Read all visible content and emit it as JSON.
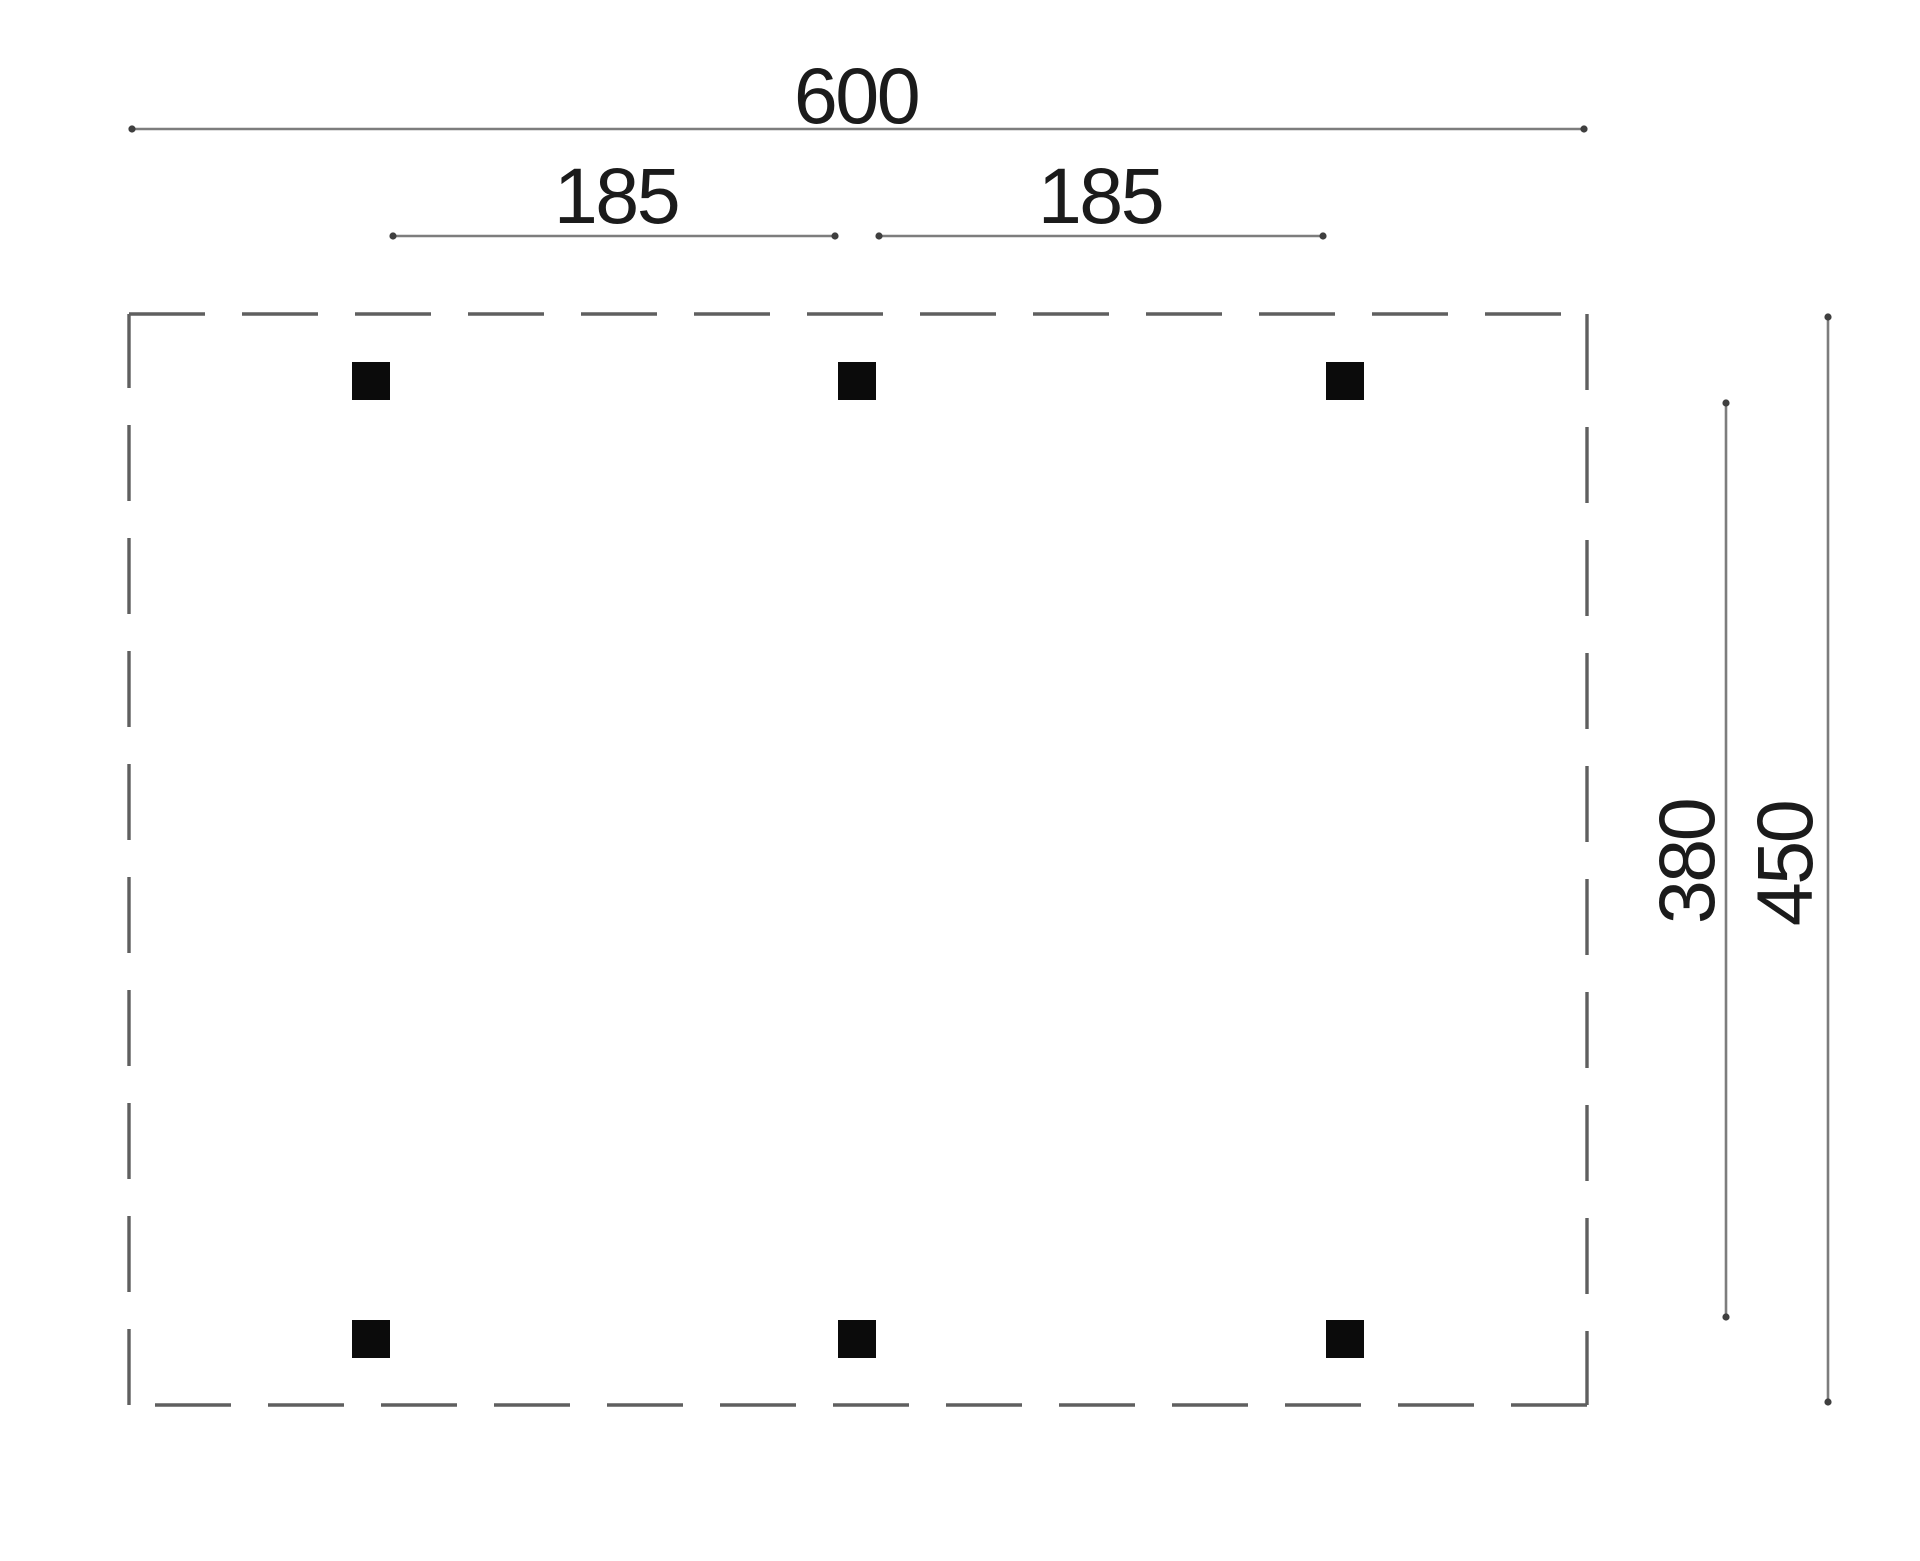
{
  "figure": {
    "kind": "post-layout dimension drawing",
    "post_count": 6,
    "labels": {
      "overall_width": "600",
      "left_post_spacing": "185",
      "right_post_spacing": "185",
      "inner_depth": "380",
      "overall_depth": "450"
    },
    "colors": {
      "post": "#0b0b0b",
      "outline": "#5f5f5f",
      "dimension_line": "#7d7d7d",
      "tick": "#3f3f3f",
      "text": "#1b1b1b",
      "background": "#ffffff"
    }
  }
}
